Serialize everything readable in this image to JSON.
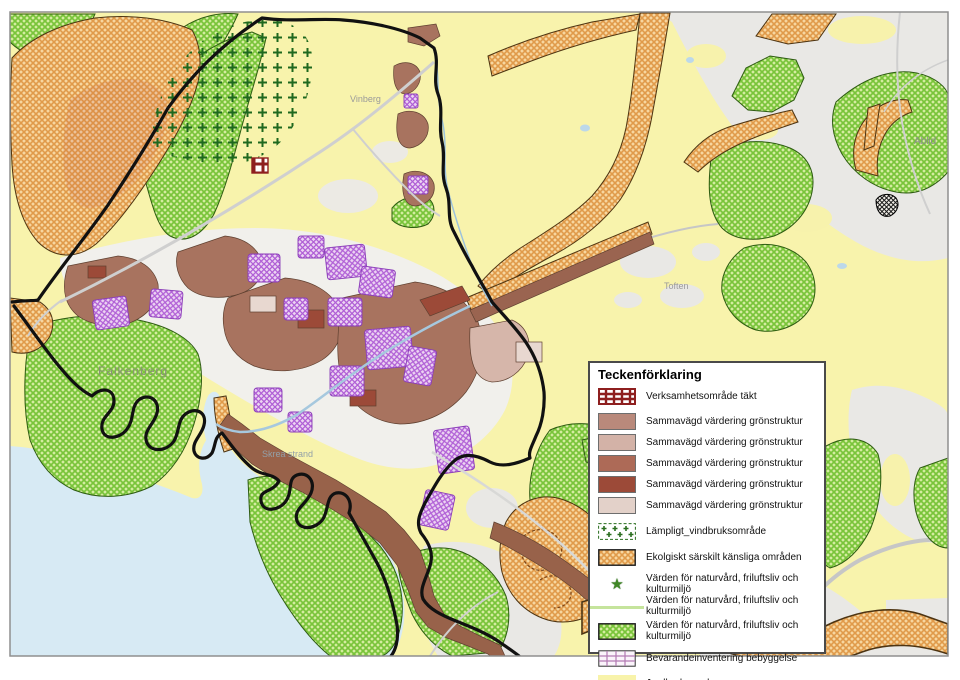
{
  "map_labels": {
    "city": "Falkenberg",
    "beach": "Skrea strand",
    "ablid": "Ablid",
    "vinberg": "Vinberg",
    "toften": "Toften"
  },
  "legend": {
    "title": "Teckenförklaring",
    "items": [
      {
        "id": "verksamhetsomrade-takt",
        "label": "Verksamhetsområde täkt"
      },
      {
        "id": "gronstruktur-1",
        "label": "Sammavägd värdering grönstruktur"
      },
      {
        "id": "gronstruktur-2",
        "label": "Sammavägd värdering grönstruktur"
      },
      {
        "id": "gronstruktur-3",
        "label": "Sammavägd värdering grönstruktur"
      },
      {
        "id": "gronstruktur-4",
        "label": "Sammavägd värdering grönstruktur"
      },
      {
        "id": "gronstruktur-5",
        "label": "Sammavägd värdering grönstruktur"
      },
      {
        "id": "vindbruksomrade",
        "label": "Lämpligt_vindbruksområde"
      },
      {
        "id": "ekologiskt-kansliga",
        "label": "Ekolgiskt särskilt känsliga områden"
      },
      {
        "id": "varden-punkt",
        "label": "Värden för naturvård, friluftsliv och kulturmiljö"
      },
      {
        "id": "varden-linje",
        "label": "Värden för naturvård, friluftsliv och kulturmiljö"
      },
      {
        "id": "varden-omrade",
        "label": "Värden för naturvård, friluftsliv och kulturmiljö"
      },
      {
        "id": "bevarandeinventering",
        "label": "Bevarandeinventering bebyggelse"
      },
      {
        "id": "jordbruksmark",
        "label": "Jordbruksmark"
      }
    ]
  },
  "colors": {
    "sea": "#d7eaf4",
    "farmland_yellow": "#f8f3ac",
    "other_land_gray": "#e9e8e5",
    "gronstruktur_1": "#b9897b",
    "gronstruktur_2": "#d3b2a7",
    "gronstruktur_3": "#ad6a57",
    "gronstruktur_4": "#9c4a38",
    "gronstruktur_5": "#e3d1c9",
    "eco_orange": "#e09a4a",
    "nature_green": "#76c437",
    "built_purple": "#b05fd6",
    "takt_dark_red": "#8e1f1f",
    "boundary_black": "#111111"
  },
  "icons": {
    "star": "★"
  }
}
